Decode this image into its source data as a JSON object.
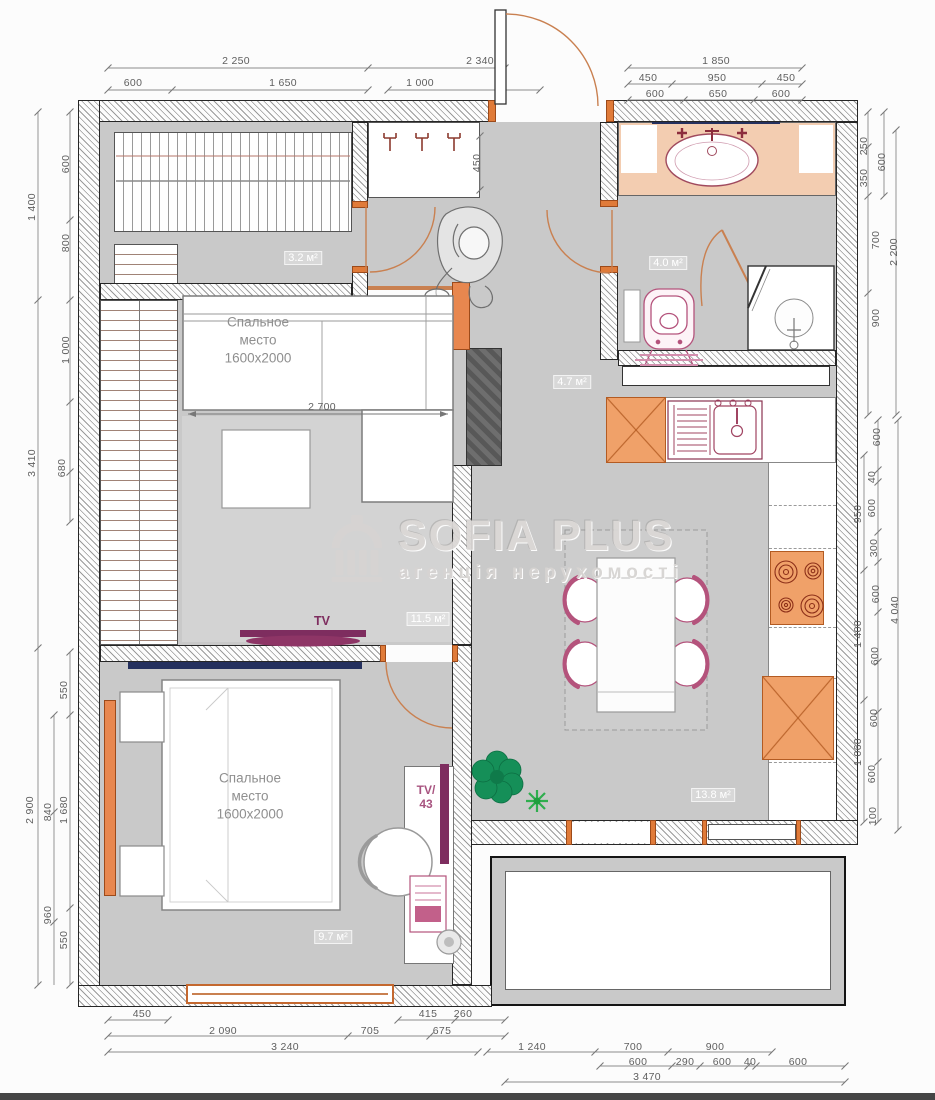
{
  "watermark": {
    "title": "SOFIA PLUS",
    "subtitle": "агенція нерухомості",
    "logo": "classical-building-icon"
  },
  "rooms": [
    {
      "name": "closet",
      "area": "3.2 м²",
      "x": 303,
      "y": 258
    },
    {
      "name": "bathroom",
      "area": "4.0 м²",
      "x": 668,
      "y": 263
    },
    {
      "name": "hallway",
      "area": "4.7 м²",
      "x": 572,
      "y": 382
    },
    {
      "name": "living-room",
      "area": "11.5 м²",
      "x": 428,
      "y": 619
    },
    {
      "name": "kitchen-dining",
      "area": "13.8 м²",
      "x": 713,
      "y": 795
    },
    {
      "name": "bedroom",
      "area": "9.7 м²",
      "x": 333,
      "y": 937
    }
  ],
  "texts": [
    {
      "kind": "bed",
      "x": 258,
      "y": 340,
      "lines": [
        "Спальное",
        "место",
        "1600x2000"
      ]
    },
    {
      "kind": "bed",
      "x": 250,
      "y": 796,
      "lines": [
        "Спальное",
        "место",
        "1600x2000"
      ]
    },
    {
      "kind": "tv",
      "x": 322,
      "y": 621,
      "lines": [
        "TV"
      ]
    },
    {
      "kind": "tv43",
      "x": 426,
      "y": 798,
      "lines": [
        "TV/",
        "43"
      ]
    }
  ],
  "dim_labels": [
    {
      "t": "2 250",
      "x": 236,
      "y": 61
    },
    {
      "t": "600",
      "x": 133,
      "y": 83
    },
    {
      "t": "1 650",
      "x": 283,
      "y": 83
    },
    {
      "t": "2 340",
      "x": 480,
      "y": 61
    },
    {
      "t": "1 000",
      "x": 420,
      "y": 83
    },
    {
      "t": "1 850",
      "x": 716,
      "y": 61
    },
    {
      "t": "450",
      "x": 648,
      "y": 78
    },
    {
      "t": "950",
      "x": 717,
      "y": 78
    },
    {
      "t": "450",
      "x": 786,
      "y": 78
    },
    {
      "t": "600",
      "x": 655,
      "y": 94
    },
    {
      "t": "650",
      "x": 718,
      "y": 94
    },
    {
      "t": "600",
      "x": 781,
      "y": 94
    },
    {
      "t": "1 400",
      "x": 32,
      "y": 207,
      "v": 1
    },
    {
      "t": "600",
      "x": 66,
      "y": 164,
      "v": 1
    },
    {
      "t": "800",
      "x": 66,
      "y": 243,
      "v": 1
    },
    {
      "t": "3 410",
      "x": 32,
      "y": 463,
      "v": 1
    },
    {
      "t": "1 000",
      "x": 66,
      "y": 350,
      "v": 1
    },
    {
      "t": "680",
      "x": 62,
      "y": 468,
      "v": 1
    },
    {
      "t": "2 900",
      "x": 30,
      "y": 810,
      "v": 1
    },
    {
      "t": "550",
      "x": 64,
      "y": 690,
      "v": 1
    },
    {
      "t": "1 680",
      "x": 64,
      "y": 810,
      "v": 1
    },
    {
      "t": "550",
      "x": 64,
      "y": 940,
      "v": 1
    },
    {
      "t": "840",
      "x": 48,
      "y": 812,
      "v": 1
    },
    {
      "t": "960",
      "x": 48,
      "y": 915,
      "v": 1
    },
    {
      "t": "250",
      "x": 864,
      "y": 146,
      "v": 1
    },
    {
      "t": "350",
      "x": 864,
      "y": 178,
      "v": 1
    },
    {
      "t": "600",
      "x": 882,
      "y": 162,
      "v": 1
    },
    {
      "t": "700",
      "x": 876,
      "y": 240,
      "v": 1
    },
    {
      "t": "900",
      "x": 876,
      "y": 318,
      "v": 1
    },
    {
      "t": "2 200",
      "x": 894,
      "y": 252,
      "v": 1
    },
    {
      "t": "600",
      "x": 877,
      "y": 437,
      "v": 1
    },
    {
      "t": "40",
      "x": 872,
      "y": 477,
      "v": 1
    },
    {
      "t": "600",
      "x": 872,
      "y": 508,
      "v": 1
    },
    {
      "t": "950",
      "x": 858,
      "y": 514,
      "v": 1
    },
    {
      "t": "300",
      "x": 874,
      "y": 548,
      "v": 1
    },
    {
      "t": "600",
      "x": 876,
      "y": 594,
      "v": 1
    },
    {
      "t": "4 040",
      "x": 895,
      "y": 610,
      "v": 1
    },
    {
      "t": "1 400",
      "x": 858,
      "y": 634,
      "v": 1
    },
    {
      "t": "600",
      "x": 875,
      "y": 656,
      "v": 1
    },
    {
      "t": "600",
      "x": 874,
      "y": 718,
      "v": 1
    },
    {
      "t": "1 060",
      "x": 858,
      "y": 752,
      "v": 1
    },
    {
      "t": "600",
      "x": 872,
      "y": 774,
      "v": 1
    },
    {
      "t": "100",
      "x": 873,
      "y": 816,
      "v": 1
    },
    {
      "t": "450",
      "x": 142,
      "y": 1014
    },
    {
      "t": "415",
      "x": 428,
      "y": 1014
    },
    {
      "t": "260",
      "x": 463,
      "y": 1014
    },
    {
      "t": "2 090",
      "x": 223,
      "y": 1031
    },
    {
      "t": "705",
      "x": 370,
      "y": 1031
    },
    {
      "t": "675",
      "x": 442,
      "y": 1031
    },
    {
      "t": "3 240",
      "x": 285,
      "y": 1047
    },
    {
      "t": "1 240",
      "x": 532,
      "y": 1047
    },
    {
      "t": "700",
      "x": 633,
      "y": 1047
    },
    {
      "t": "900",
      "x": 715,
      "y": 1047
    },
    {
      "t": "600",
      "x": 638,
      "y": 1062
    },
    {
      "t": "290",
      "x": 685,
      "y": 1062
    },
    {
      "t": "600",
      "x": 722,
      "y": 1062
    },
    {
      "t": "40",
      "x": 750,
      "y": 1062
    },
    {
      "t": "600",
      "x": 798,
      "y": 1062
    },
    {
      "t": "3 470",
      "x": 647,
      "y": 1077
    },
    {
      "t": "450",
      "x": 477,
      "y": 163,
      "v": 1
    },
    {
      "t": "2 700",
      "x": 322,
      "y": 407
    }
  ],
  "colors": {
    "floor": "#c9c9c9",
    "rug": "#d3d3d3",
    "wall_line": "#262626",
    "accent_orange": "#e07b39",
    "cabinet_orange": "#f0a169",
    "door_orange": "#c98050",
    "fixture_pink": "#b4537c",
    "tv_purple": "#7e2d5f",
    "mirror_navy": "#24305e",
    "plant_green": "#158f58",
    "dim_text": "#5f5f5f",
    "watermark_gray": "#d9d6d4"
  }
}
